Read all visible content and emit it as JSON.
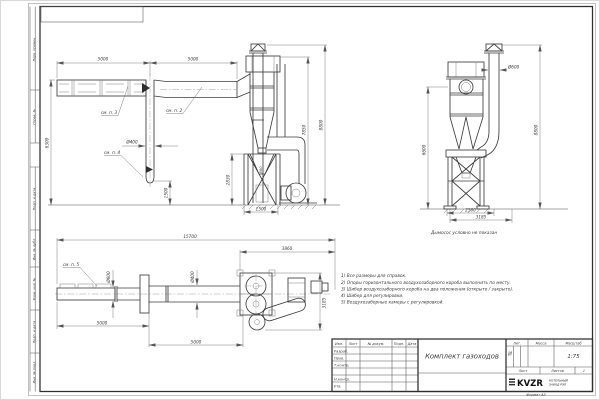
{
  "sheet": {
    "format_note": "Формат А3"
  },
  "margin": {
    "items": [
      "Перв. примен.",
      "Справ. №",
      "Подп. и дата",
      "Инв. № дубл.",
      "Взам. инв. №",
      "Подп. и дата",
      "Инв. № подл."
    ]
  },
  "notes": [
    "1) Все размеры для справок.",
    "2) Опоры горизонтального воздухозаборного короба выполнить по месту.",
    "3) Шибер воздухозаборного короба на два положения (открыто / закрыто).",
    "4) Шибер для регулировки.",
    "5) Воздухозаборные камеры с регулировкой."
  ],
  "views": {
    "side_elevation": {
      "len1": "5000",
      "len2": "5000",
      "height": "6300",
      "pipe_dia": "Ø400",
      "pipe_len": "1500",
      "callout2": "см. п. 2",
      "callout3": "см. п. 3",
      "callout4": "см. п. 4"
    },
    "front": {
      "bin_height": "2830",
      "gap": "500",
      "bin_width": "1500",
      "h_inner": "7850",
      "h_total": "8800"
    },
    "side": {
      "dia": "Ø600",
      "h_total": "8800",
      "h_cyclone": "6600",
      "w_base": "2560",
      "w_total": "3185",
      "note": "Дымосос условно не показан"
    },
    "plan": {
      "total": "15700",
      "right": "3860",
      "dia1": "Ø600",
      "dia2": "Ø400",
      "seg1": "5000",
      "seg2": "5000",
      "depth": "3185",
      "callout5": "см. п. 5"
    }
  },
  "title_block": {
    "cols": [
      "Изм.",
      "Лист",
      "№ докум.",
      "Подп.",
      "Дата"
    ],
    "roles": [
      "Разраб.",
      "Пров.",
      "Т.контр.",
      "Н.контр.",
      "Утв."
    ],
    "doc_title": "Комплект газоходов",
    "lit_label": "Лит.",
    "lit_value": "И",
    "mass_label": "Масса",
    "scale_label": "Масштаб",
    "scale_value": "1:75",
    "sheet_label": "Лист",
    "sheets_label": "Листов",
    "sheets_value": "1",
    "logo_text": "KVZR",
    "company_line1": "КОТЕЛЬНЫЙ",
    "company_line2": "ЗАВОД РЭП"
  }
}
